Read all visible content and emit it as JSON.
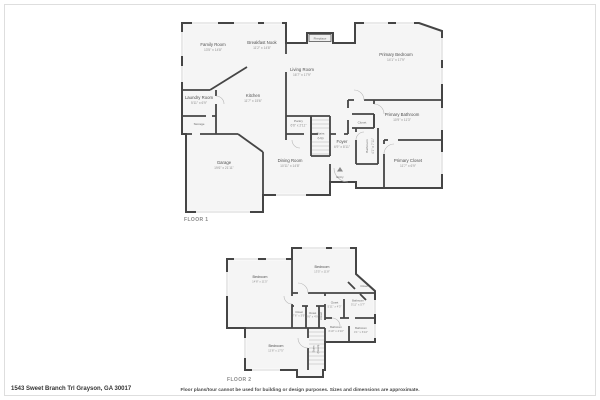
{
  "footer": {
    "address": "1543 Sweet Branch Trl Grayson, GA 30017",
    "disclaimer": "Floor plans/tour cannot be used for building or design purposes. Sizes and dimensions are approximate."
  },
  "floor1": {
    "label": "FLOOR 1",
    "rooms": {
      "family": {
        "name": "Family Room",
        "dims": "13'5\" x 14'8\""
      },
      "breakfast": {
        "name": "Breakfast Nook",
        "dims": "11'2\" x 14'8\""
      },
      "fireplace": {
        "name": "Fireplace"
      },
      "living": {
        "name": "Living Room",
        "dims": "16'7\" x 17'9\""
      },
      "primary_bedroom": {
        "name": "Primary Bedroom",
        "dims": "14'1\" x 17'9\""
      },
      "kitchen": {
        "name": "Kitchen",
        "dims": "11'7\" x 15'6\""
      },
      "laundry": {
        "name": "Laundry Room",
        "dims": "5'11\" x 6'9\""
      },
      "storage": {
        "name": "Storage"
      },
      "garage": {
        "name": "Garage",
        "dims": "19'6\" x 21'11\""
      },
      "pantry": {
        "name": "Pantry",
        "dims": "6'6\" x 2'11\""
      },
      "stairs": {
        "name": "Stairs",
        "dir": "(Up)"
      },
      "foyer": {
        "name": "Foyer",
        "dims": "6'9\" x 8'11\""
      },
      "dining": {
        "name": "Dining Room",
        "dims": "10'11\" x 14'8\""
      },
      "entry": {
        "name": "Entry"
      },
      "closet": {
        "name": "Closet"
      },
      "bathroom": {
        "name": "Bathroom",
        "dims": "4'1\" x 7'11\""
      },
      "primary_bathroom": {
        "name": "Primary Bathroom",
        "dims": "10'9\" x 11'3\""
      },
      "primary_closet": {
        "name": "Primary Closet",
        "dims": "11'7\" x 6'9\""
      }
    }
  },
  "floor2": {
    "label": "FLOOR 2",
    "rooms": {
      "bedroom_a": {
        "name": "Bedroom",
        "dims": "14'8\" x 11'5\""
      },
      "bedroom_b": {
        "name": "Bedroom",
        "dims": "13'5\" x 11'8\""
      },
      "bedroom_c": {
        "name": "Bedroom",
        "dims": "12'8\" x 17'5\""
      },
      "closet_corner": {
        "name": "Closet"
      },
      "closet_mid": {
        "name": "Closet",
        "dims": "5'11\" x 4'3\""
      },
      "bath_a": {
        "name": "Bathroom",
        "dims": "5'11\" x 5'7\""
      },
      "bath_b": {
        "name": "Bathroom",
        "dims": "4'10\" x 4'10\""
      },
      "bath_c": {
        "name": "Bathroom",
        "dims": "4'1\" x 6'10\""
      },
      "closet_a": {
        "name": "Closet",
        "dims": "7'6\" x 3'9\""
      },
      "closet_b": {
        "name": "Closet",
        "dims": "3'6\" x 4'9\""
      },
      "closet_c": {
        "name": "Closet"
      },
      "stairs": {
        "name": "Stairs",
        "dir": "(Down)"
      }
    }
  }
}
